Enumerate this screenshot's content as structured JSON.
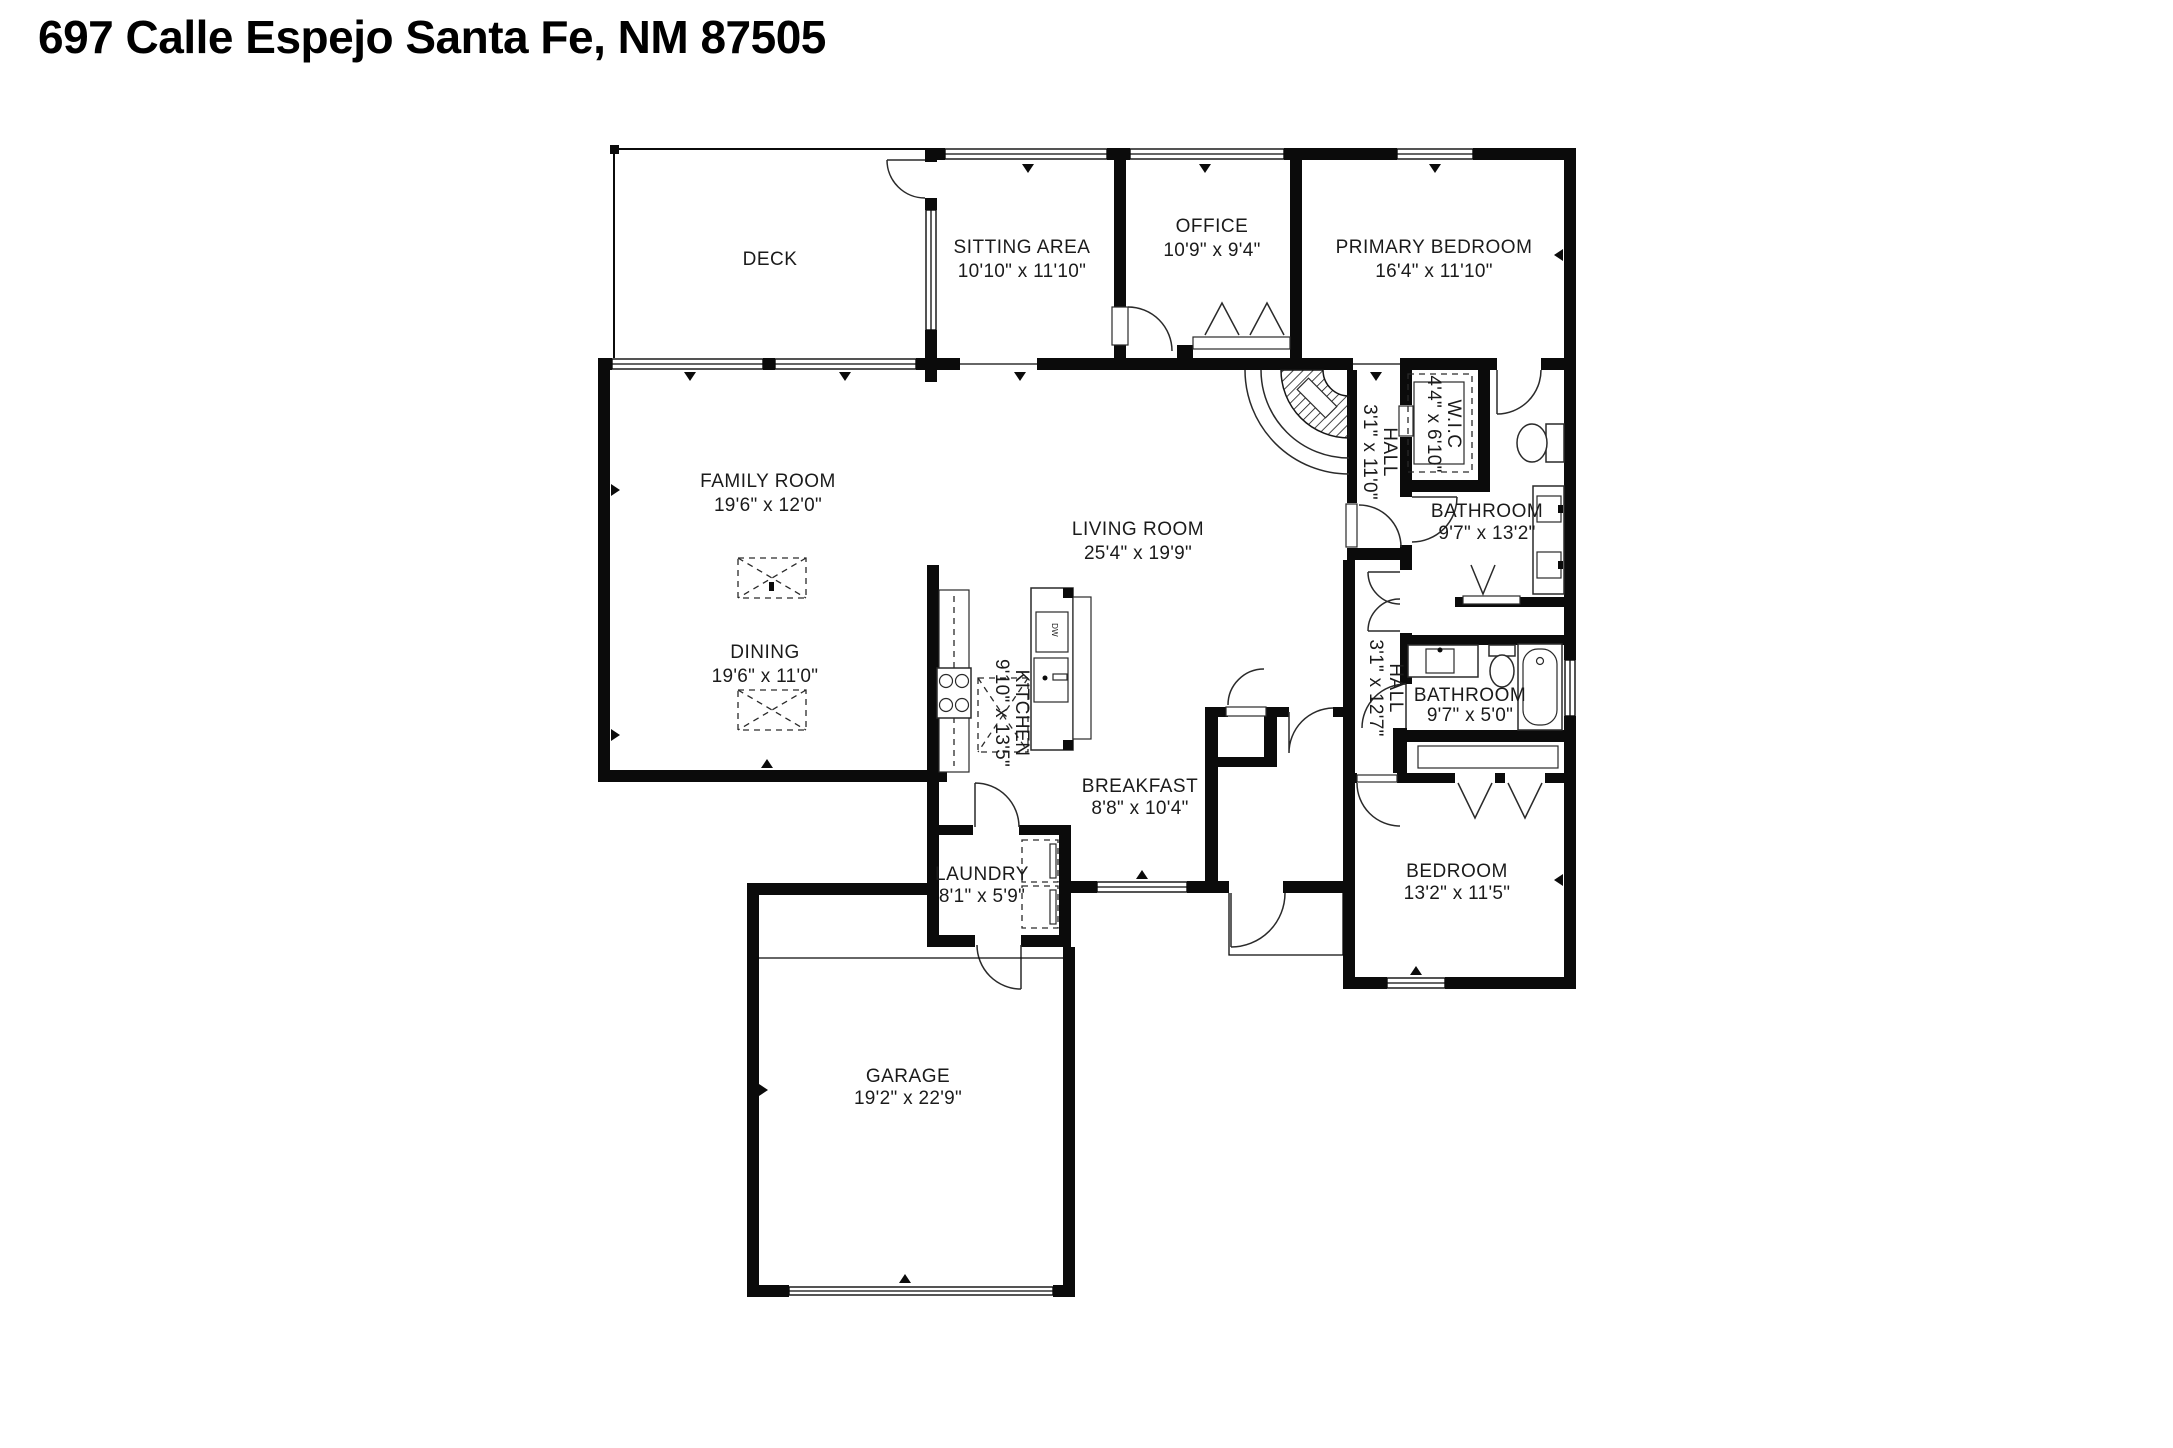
{
  "title": "697 Calle Espejo Santa Fe, NM 87505",
  "colors": {
    "wall": "#0b0b0b",
    "text": "#1b1b1b",
    "background": "#ffffff"
  },
  "rooms": {
    "deck": {
      "name": "DECK",
      "dims": ""
    },
    "sitting": {
      "name": "SITTING AREA",
      "dims": "10'10\" x 11'10\""
    },
    "office": {
      "name": "OFFICE",
      "dims": "10'9\" x 9'4\""
    },
    "primary_bedroom": {
      "name": "PRIMARY BEDROOM",
      "dims": "16'4\" x 11'10\""
    },
    "family_room": {
      "name": "FAMILY ROOM",
      "dims": "19'6\" x 12'0\""
    },
    "living_room": {
      "name": "LIVING ROOM",
      "dims": "25'4\" x 19'9\""
    },
    "dining": {
      "name": "DINING",
      "dims": "19'6\" x 11'0\""
    },
    "kitchen": {
      "name": "KITCHEN",
      "dims": "9'10\" x 13'5\""
    },
    "hall_upper": {
      "name": "HALL",
      "dims": "3'1\" x 11'0\""
    },
    "wic": {
      "name": "W.I.C",
      "dims": "4'4\" x 6'10\""
    },
    "bathroom_primary": {
      "name": "BATHROOM",
      "dims": "9'7\" x 13'2\""
    },
    "hall_lower": {
      "name": "HALL",
      "dims": "3'1\" x 12'7\""
    },
    "bathroom_hall": {
      "name": "BATHROOM",
      "dims": "9'7\" x 5'0\""
    },
    "breakfast": {
      "name": "BREAKFAST",
      "dims": "8'8\" x 10'4\""
    },
    "laundry": {
      "name": "LAUNDRY",
      "dims": "8'1\" x 5'9\""
    },
    "bedroom": {
      "name": "BEDROOM",
      "dims": "13'2\" x 11'5\""
    },
    "garage": {
      "name": "GARAGE",
      "dims": "19'2\" x 22'9\""
    }
  },
  "fixtures": {
    "dishwasher": "DW"
  }
}
